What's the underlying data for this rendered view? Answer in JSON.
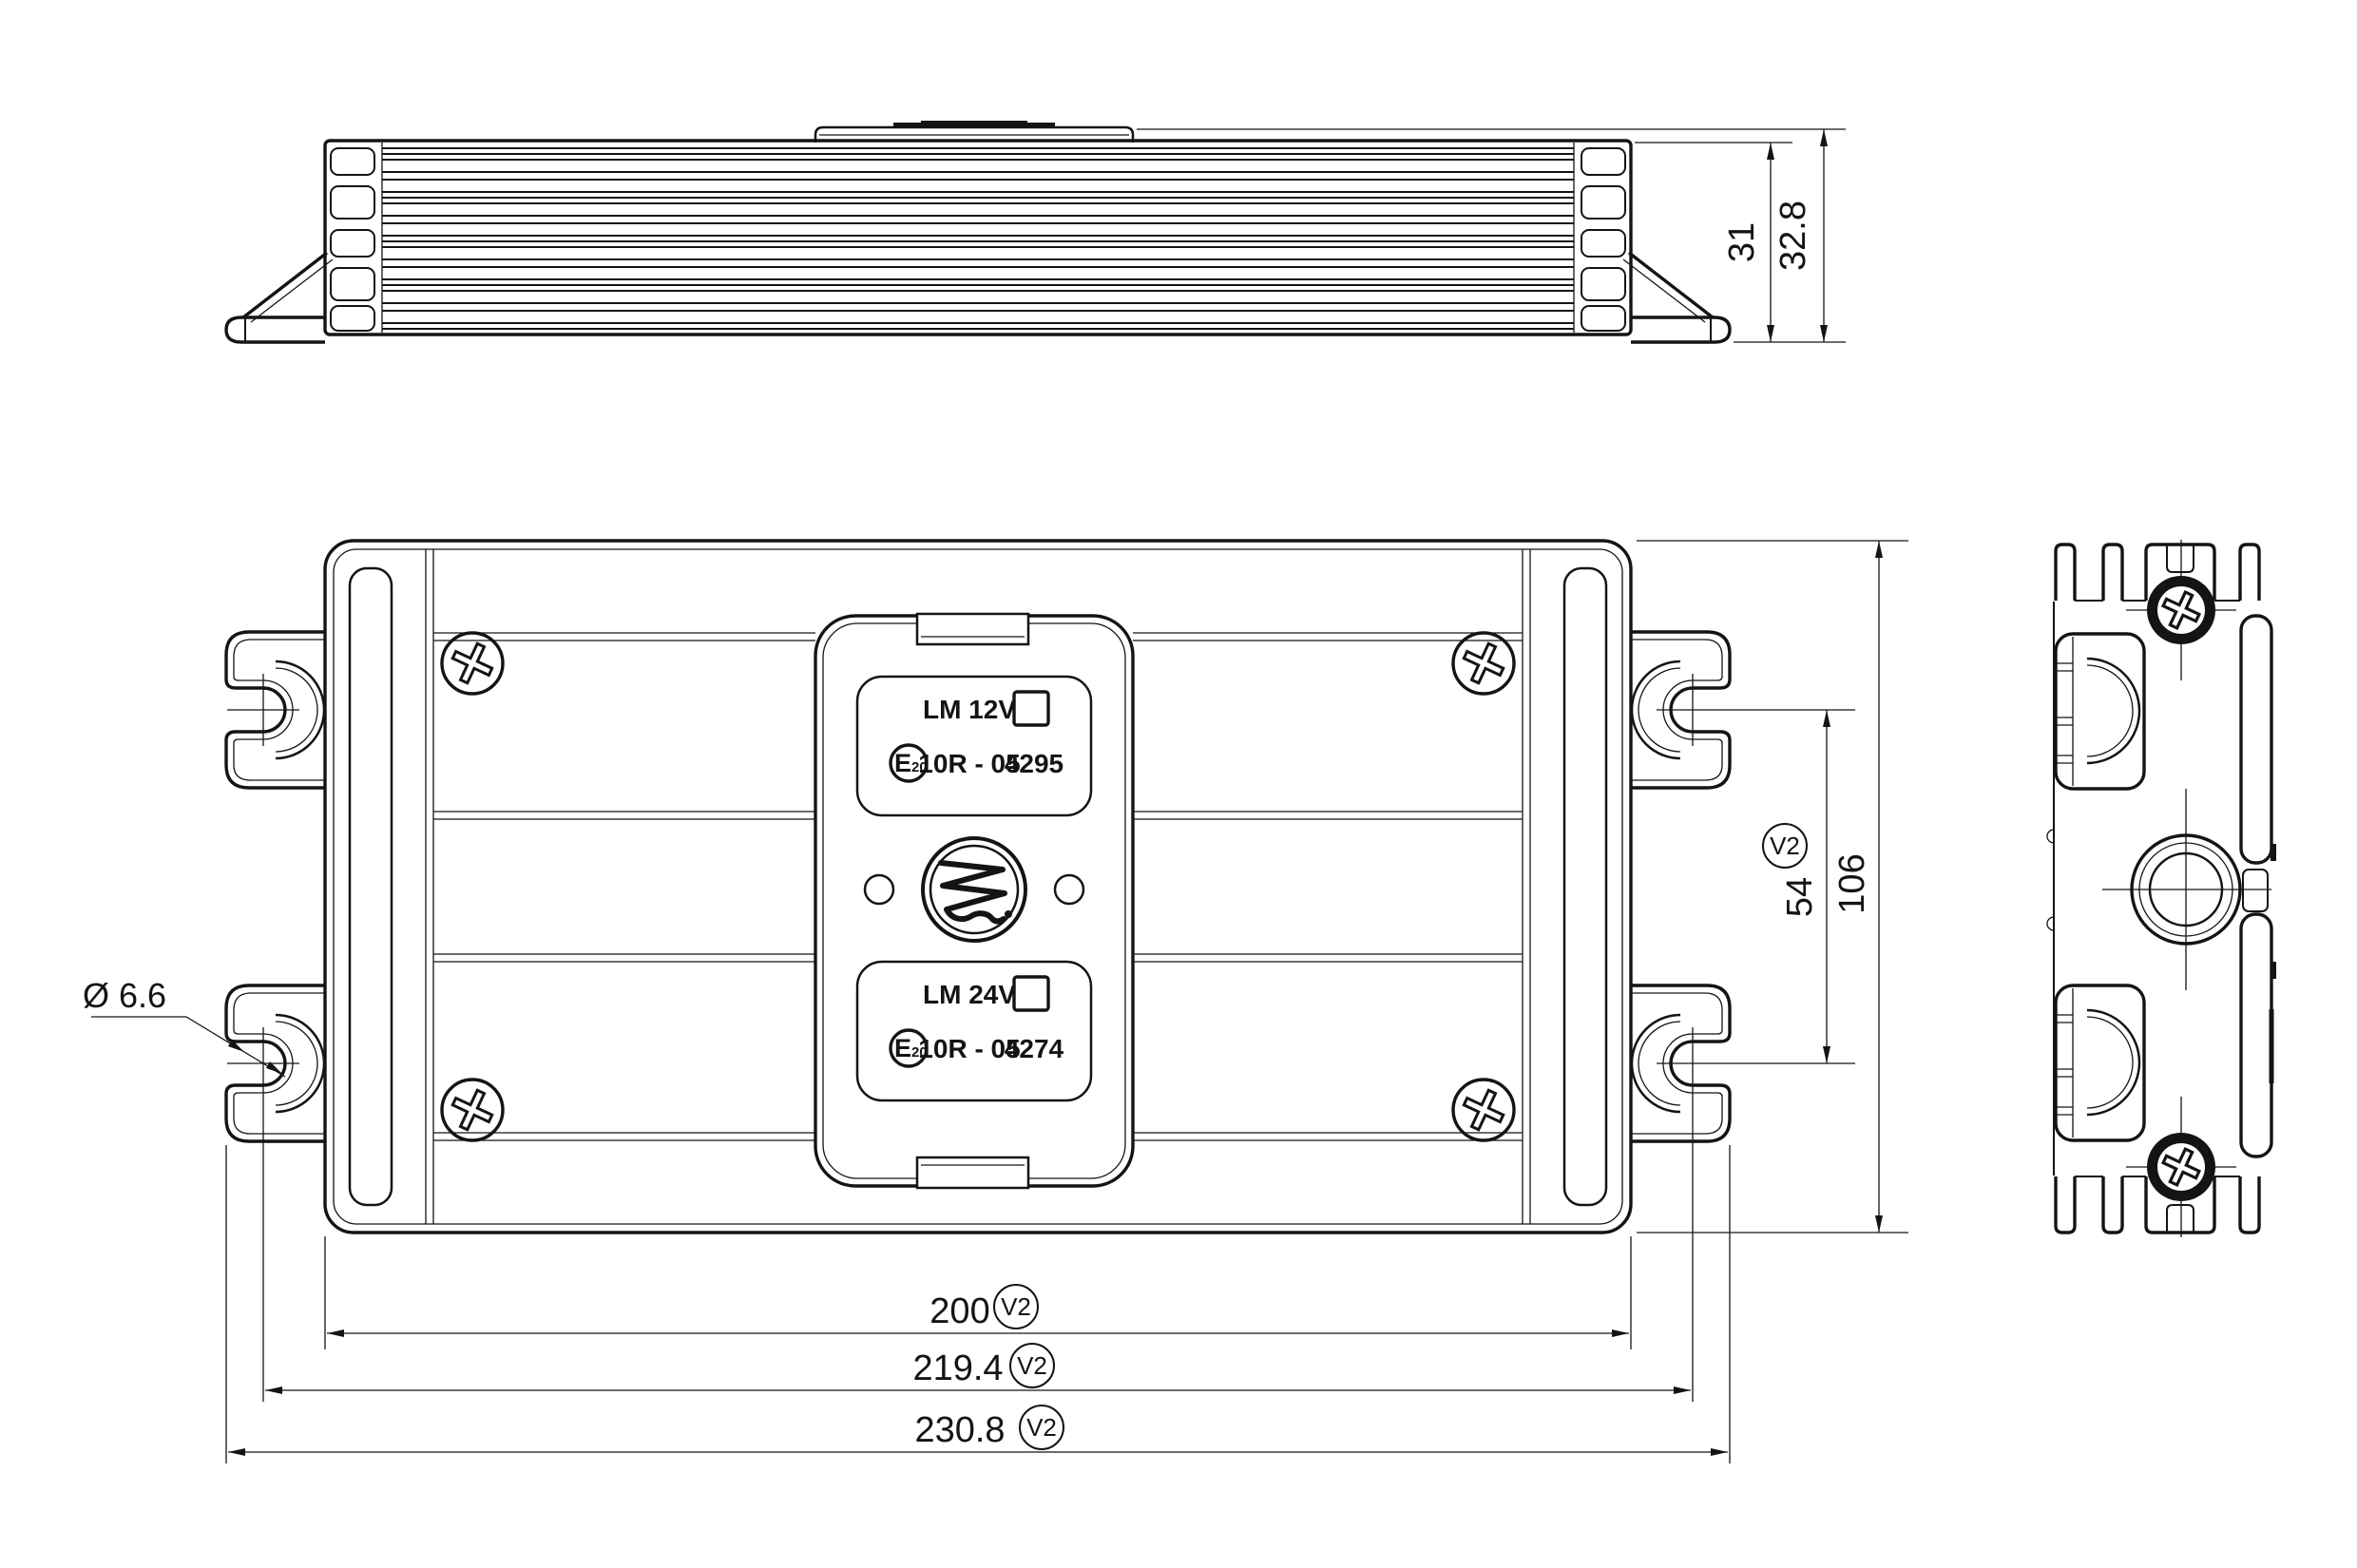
{
  "drawing": {
    "dimensions": {
      "height_body": "31",
      "height_overall": "32.8",
      "front_height": "106",
      "slot_spacing": "54",
      "width_body": "200",
      "width_slot_centers": "219.4",
      "width_overall": "230.8",
      "hole_diameter": "Ø 6.6",
      "version_tag": "V2"
    },
    "labels": {
      "label_12v": {
        "model": "LM 12V",
        "approval": "10R - 05",
        "number": "4295"
      },
      "label_24v": {
        "model": "LM 24V",
        "approval": "10R - 05",
        "number": "4274"
      },
      "e_mark_letter": "E",
      "e_mark_number": "20"
    }
  }
}
